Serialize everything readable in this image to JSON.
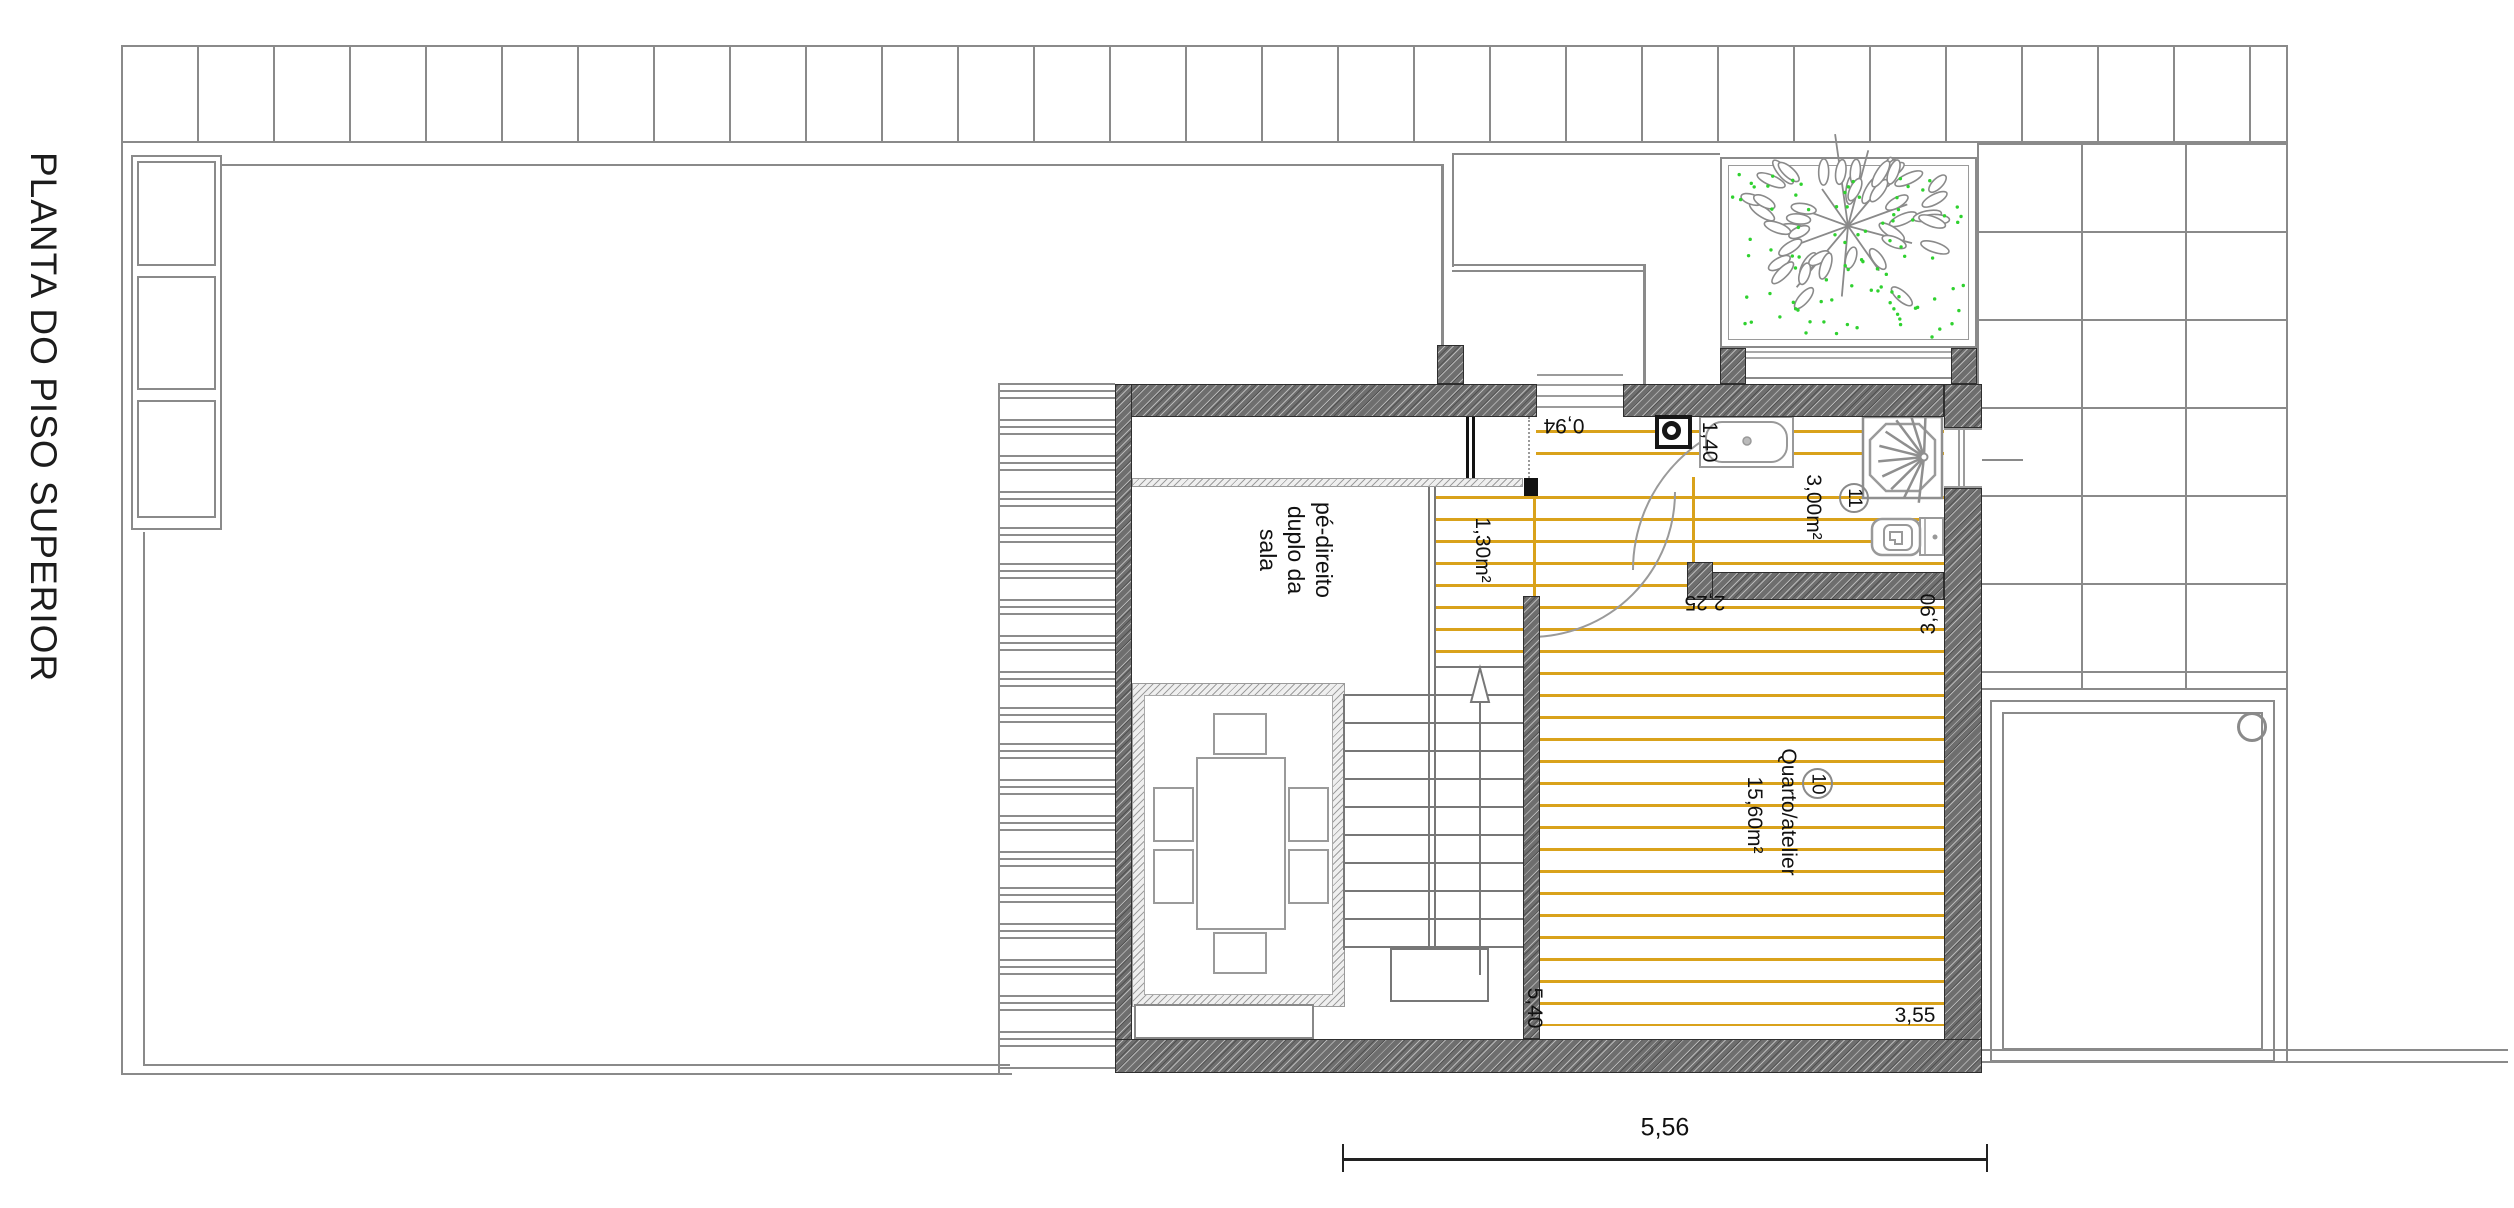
{
  "title": "PLANTA DO PISO SUPERIOR",
  "rooms": {
    "void": {
      "label_lines": [
        "pé-direito",
        "duplo da",
        "sala"
      ]
    },
    "bedroom": {
      "number": "10",
      "name": "Quarto/atelier",
      "area": "15,60m²"
    },
    "bathroom": {
      "number": "11",
      "area": "3,00m²"
    }
  },
  "dimensions": {
    "opening": "0,94",
    "sink_wall": "1,40",
    "landing_area": "1,30m²",
    "bathroom_width": "2,25",
    "bedroom_depth": "3,90",
    "bedroom_length": "5,40",
    "bedroom_width": "3,55",
    "overall_width": "5,56"
  },
  "colors": {
    "wood_line": "#d9a21b",
    "plant_green": "#2fd12f",
    "wall_gray": "#6e6e6e",
    "line_gray": "#8a8a8a"
  }
}
